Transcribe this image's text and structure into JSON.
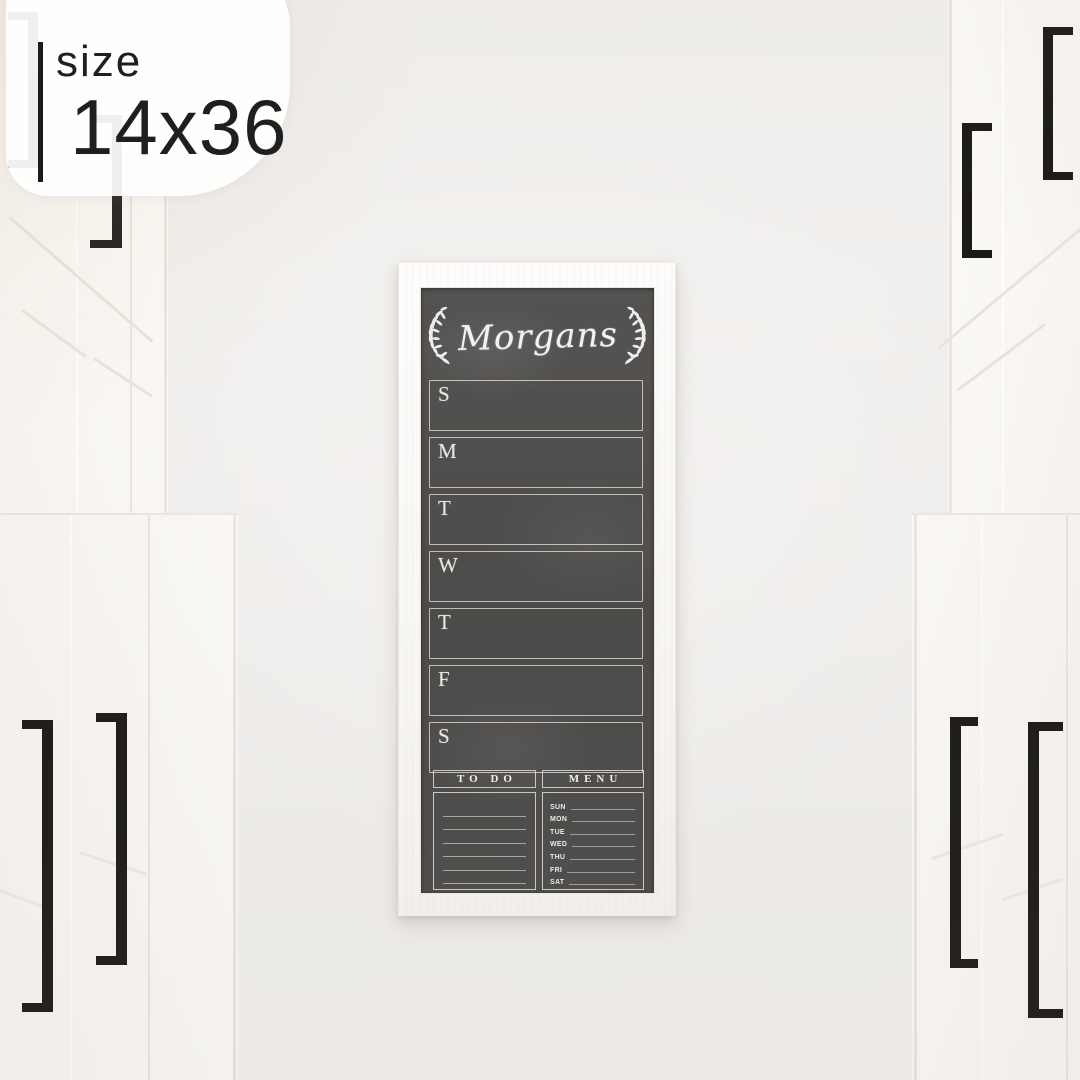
{
  "badge": {
    "label": "size",
    "value": "14x36"
  },
  "board": {
    "family_name": "Morgans",
    "days": [
      "S",
      "M",
      "T",
      "W",
      "T",
      "F",
      "S"
    ],
    "todo_title": "TO DO",
    "menu_title": "MENU",
    "menu_days": [
      "SUN",
      "MON",
      "TUE",
      "WED",
      "THU",
      "FRI",
      "SAT"
    ]
  },
  "colors": {
    "wall": "#f1efed",
    "cabinet": "#f9f7f4",
    "handle": "#1a1918",
    "frame": "#fbf9f6",
    "chalkboard": "#514f4d",
    "chalk": "#f0eeec",
    "badge_text": "#1f1f1f"
  }
}
